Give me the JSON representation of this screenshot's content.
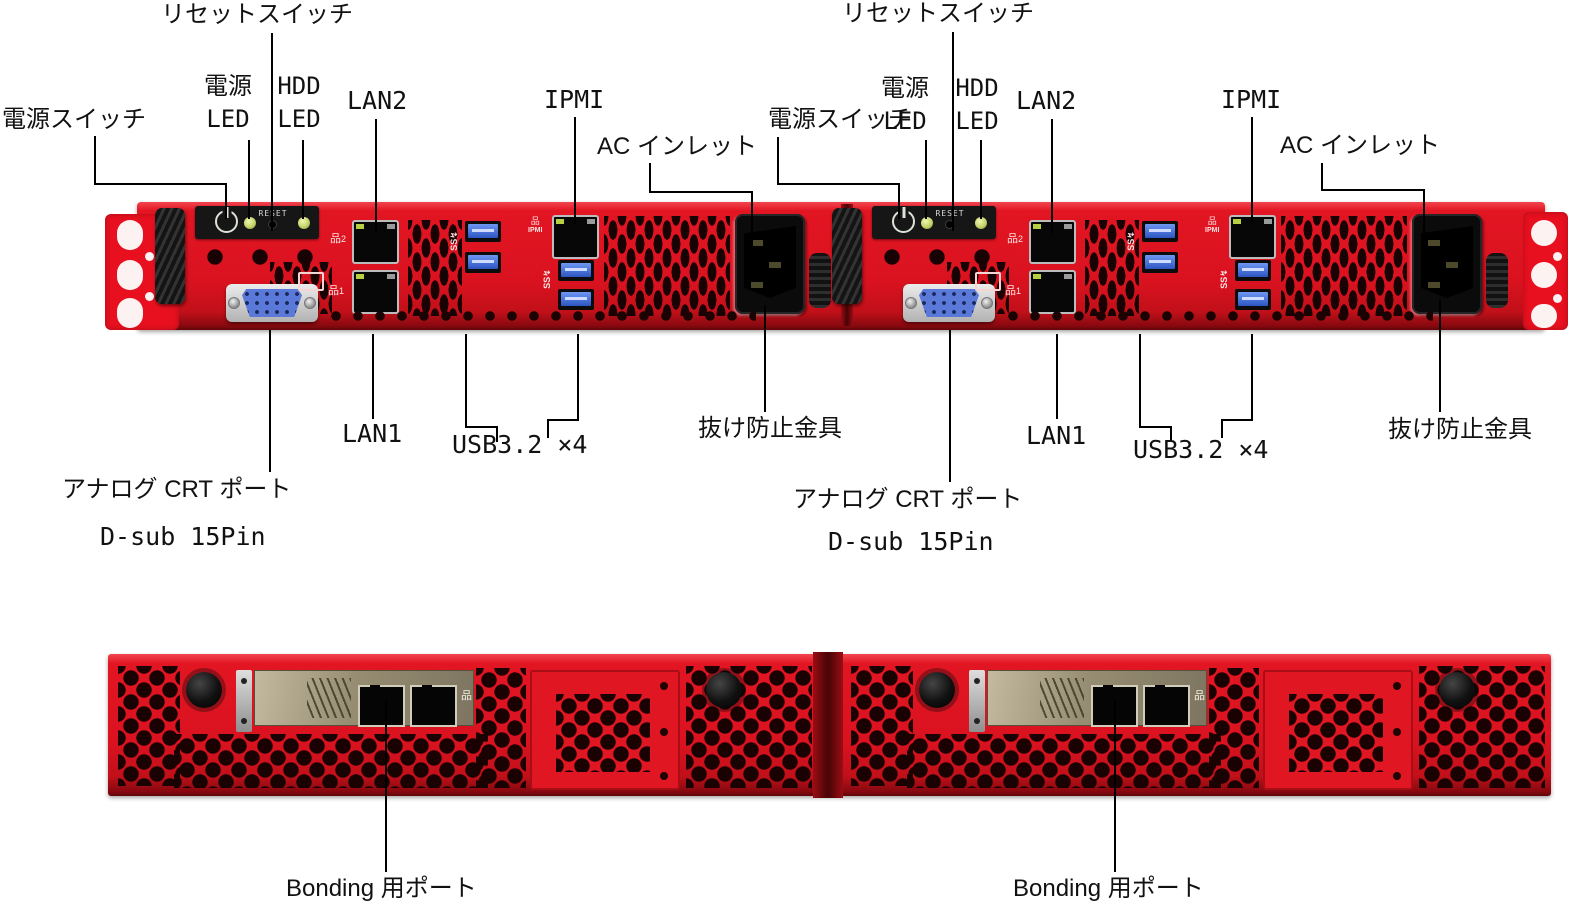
{
  "figure": {
    "type": "server-hardware-diagram",
    "views": [
      "front",
      "rear"
    ],
    "units_per_view": 2
  },
  "callouts": {
    "reset_switch": "リセットスイッチ",
    "power_switch": "電源スイッチ",
    "power_led": [
      "電源",
      "LED"
    ],
    "hdd_led": [
      "HDD",
      "LED"
    ],
    "lan2": "LAN2",
    "ipmi": "IPMI",
    "ac_inlet": "AC インレット",
    "lan1": "LAN1",
    "usb": "USB3.2 ×4",
    "retention_clip": "抜け防止金具",
    "analog_crt_port": "アナログ CRT ポート",
    "dsub_15pin": "D-sub 15Pin",
    "bonding_port": "Bonding 用ポート"
  },
  "panel_text": {
    "reset": "RESET"
  },
  "icons": {
    "power_icon": "standby-power-symbol",
    "network_icon_glyph": "品",
    "lan2_icon_num": "2",
    "lan1_icon_num": "1",
    "ipmi_icon_label": "IPMI",
    "usb_ss_icon": "SS",
    "monitor_icon": "crt-display-outline"
  },
  "colors": {
    "chassis_red": "#e01522",
    "panel_black": "#161616",
    "usb_blue": "#3a66d6",
    "vga_blue": "#5b79d8",
    "led_green": "#c6d36a",
    "leader_line": "#000000",
    "label_text": "#111111"
  }
}
